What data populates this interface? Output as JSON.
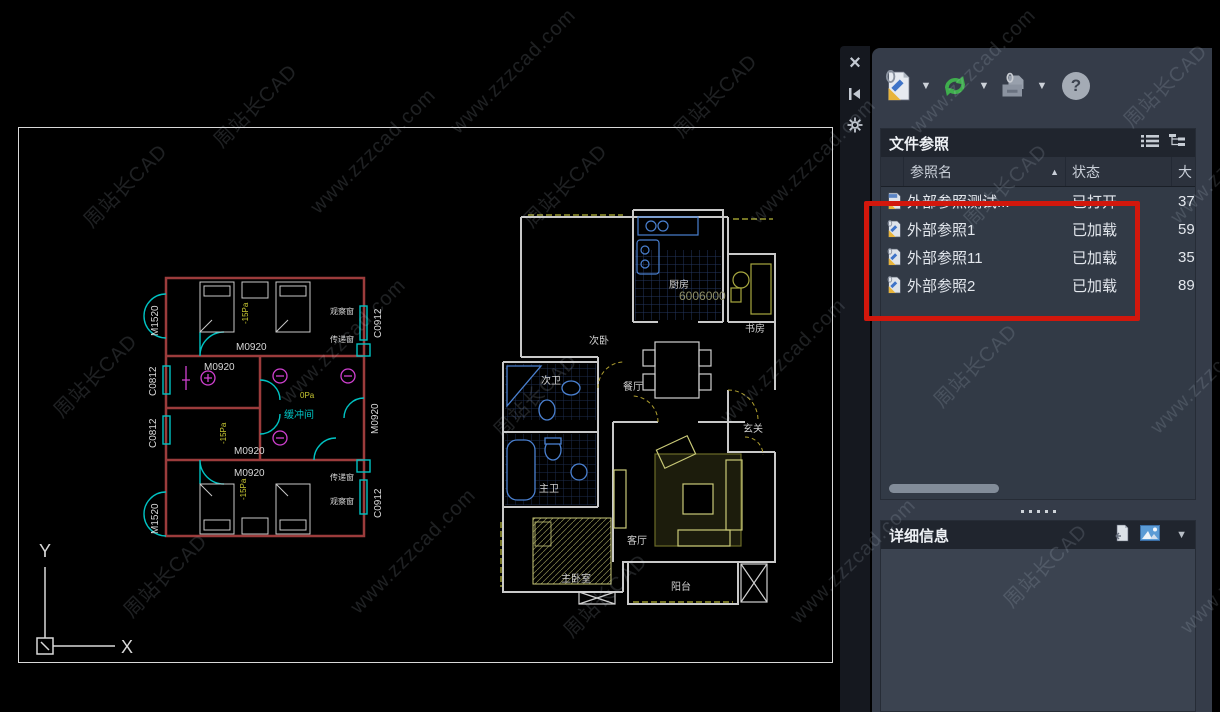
{
  "palette": {
    "titlebar": {
      "close": "×",
      "autohide": "◀"
    },
    "toolbar": {
      "dropdown_arrow": "▼",
      "help": "?"
    },
    "xref_panel": {
      "title": "文件参照",
      "columns": {
        "name": "参照名",
        "status": "状态",
        "size": "大"
      },
      "sort_arrow": "▲",
      "rows": [
        {
          "name": "外部参照测试...",
          "status": "已打开",
          "size": "37"
        },
        {
          "name": "外部参照1",
          "status": "已加载",
          "size": "59"
        },
        {
          "name": "外部参照11",
          "status": "已加载",
          "size": "35"
        },
        {
          "name": "外部参照2",
          "status": "已加载",
          "size": "89"
        }
      ]
    },
    "details_panel": {
      "title": "详细信息",
      "collapse_arrow": "▼"
    }
  },
  "watermark": {
    "line1": "周站长CAD",
    "line2": "www.zzzcad.com"
  },
  "ucs": {
    "x": "X",
    "y": "Y"
  },
  "left_plan": {
    "door_left": "M1520",
    "door_inner": "M0920",
    "window_right": "C0912",
    "window_left": "C0812",
    "obs_window": "观察窗",
    "pass_window": "传递窗",
    "buffer_room": "缓冲间",
    "pressure_neg": "-15Pa",
    "pressure_zero": "0Pa"
  },
  "right_plan": {
    "bedroom2": "次卧",
    "kitchen": "厨房",
    "study": "书房",
    "dining": "餐厅",
    "bath2": "次卫",
    "bath1": "主卫",
    "entry": "玄关",
    "living": "客厅",
    "master": "主卧室",
    "balcony": "阳台",
    "dim": "6006000"
  },
  "colors": {
    "accent_red": "#d2170c",
    "refresh_green": "#3fae4d",
    "wall_red": "#9c3c3c",
    "cad_cyan": "#00c2c2",
    "cad_yellow": "#c8c832",
    "cad_magenta": "#d040d0",
    "fixture_blue": "#4a80d0"
  }
}
